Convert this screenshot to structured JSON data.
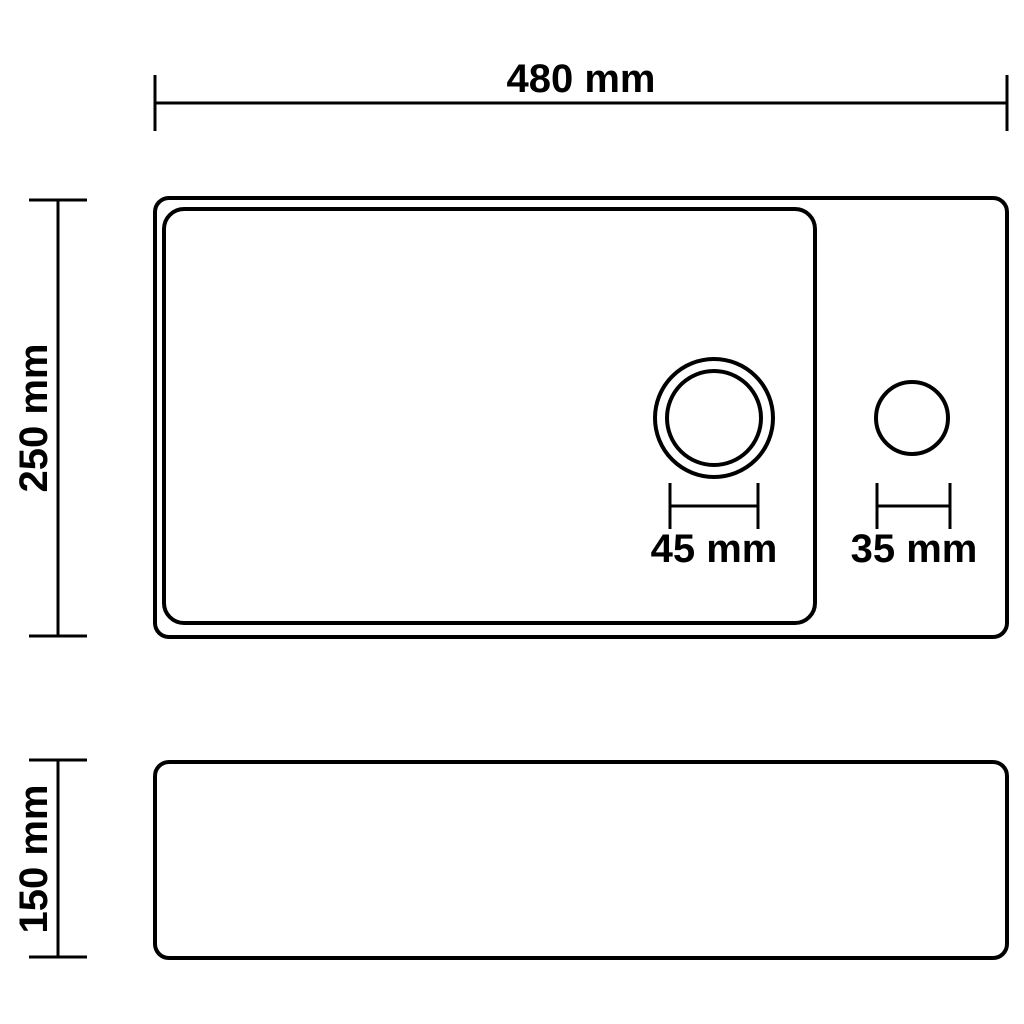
{
  "drawing": {
    "colors": {
      "line": "#000000",
      "background": "#ffffff"
    },
    "top_view": {
      "width_label": "480 mm",
      "depth_label": "250 mm",
      "drain_hole_label": "45 mm",
      "faucet_hole_label": "35 mm"
    },
    "side_view": {
      "height_label": "150 mm"
    }
  }
}
